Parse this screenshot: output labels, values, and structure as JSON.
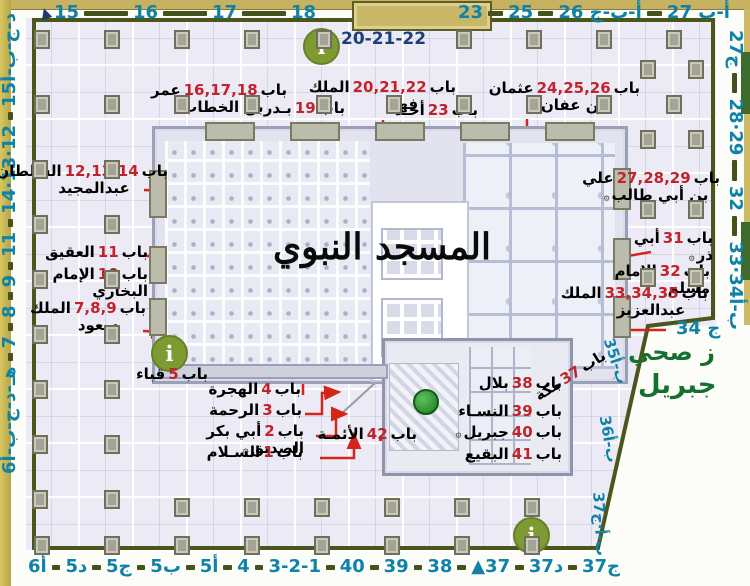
{
  "title": "المسجد النبوي",
  "word_bab": "باب",
  "info_icon": "i",
  "pointer_icon": "▲",
  "top_sub": "20-21-22",
  "right_corner": "ج 34",
  "green_labels": {
    "line1": "ز صحي",
    "line2": "جبريل"
  },
  "edge_numbers": {
    "top_left": [
      "15",
      "16",
      "17",
      "18"
    ],
    "top_right": [
      "23",
      "25",
      "أ-ب-ج 26",
      "أ-ب 27"
    ],
    "left": [
      "د-ج-ب-أ15",
      "12·13·14",
      "11",
      "9",
      "8",
      "7",
      "هـ-د-ج-ب-أ6"
    ],
    "right": [
      "27ج",
      "28·29",
      "32",
      "33·34ب-أ"
    ],
    "diag": [
      "35ب-أ",
      "36ب-أ",
      "37ب-أ·ج"
    ],
    "bottom": [
      "أ6",
      "د5",
      "ج5",
      "ب5",
      "أ5",
      "4",
      "3-2-1",
      "40",
      "39",
      "38",
      "▲37",
      "د37",
      "ج37"
    ]
  },
  "gates": [
    {
      "num": "16,17,18",
      "name": "عمر بن الخطاب",
      "h": "۞"
    },
    {
      "num": "19",
      "name": "بـدر"
    },
    {
      "num": "20,21,22",
      "name": "الملك فهد"
    },
    {
      "num": "23",
      "name": "أحـد"
    },
    {
      "num": "24,25,26",
      "name": "عثمان بن عفان",
      "h": "۞"
    },
    {
      "num": "12,13,14",
      "name": "السلطان عبدالمجيد"
    },
    {
      "num": "11",
      "name": "العقيق"
    },
    {
      "num": "10",
      "name": "الإمام البخاري"
    },
    {
      "num": "7,8,9",
      "name": "الملك سعود"
    },
    {
      "num": "5",
      "name": "قباء"
    },
    {
      "num": "4",
      "name": "الهجرة"
    },
    {
      "num": "3",
      "name": "الرحمة"
    },
    {
      "num": "2",
      "name": "أبي بكر الصديق",
      "h": "۞"
    },
    {
      "num": "1",
      "name": "السـلام"
    },
    {
      "num": "42",
      "name": "الأئمـة"
    },
    {
      "num": "37",
      "name": "مكة"
    },
    {
      "num": "38",
      "name": "بلال"
    },
    {
      "num": "39",
      "name": "النسـاء"
    },
    {
      "num": "40",
      "name": "جبريل",
      "h": "۞"
    },
    {
      "num": "41",
      "name": "البقيع"
    },
    {
      "num": "27,28,29",
      "name": "علي بن أبي طالب",
      "h": "۞"
    },
    {
      "num": "31",
      "name": "أبي ذر",
      "h": "۞"
    },
    {
      "num": "32",
      "name": "الإمام مسلم"
    },
    {
      "num": "33,34,35",
      "name": "الملك عبدالعزيز"
    }
  ],
  "colors": {
    "edge_number": "#0f82a8",
    "gate_number_red": "#c2222b",
    "arrow_red": "#d42518",
    "wall_olive": "#4b561c",
    "info_green": "#7e9b31",
    "dome_green": "#1e7a22",
    "street_tan": "#c6b260",
    "green_text": "#15702f",
    "top_sub_navy": "#1d3f77"
  }
}
